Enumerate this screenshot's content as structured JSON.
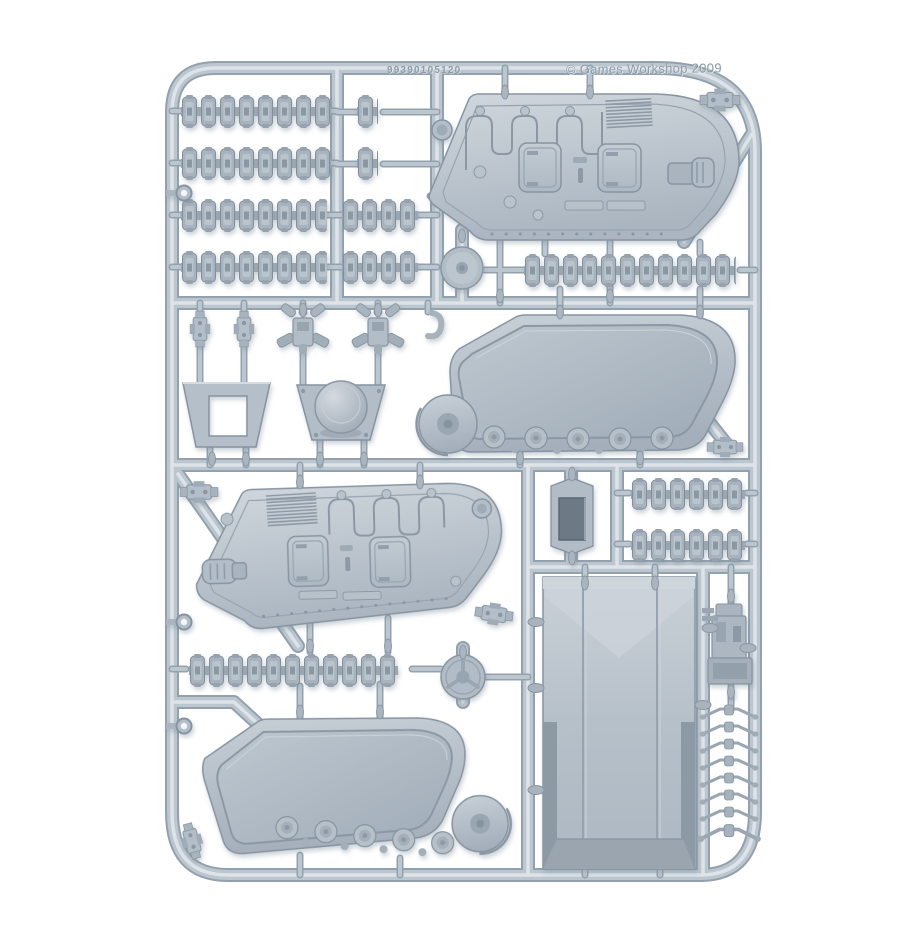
{
  "meta": {
    "description": "Product photograph of a light grey-blue plastic model sprue (injection-moulded frame) for a tracked tank kit, shot on a plain white background",
    "manufacturer_visible": "Games Workshop"
  },
  "palette": {
    "background": "#ffffff",
    "runner-shadow": "#93a1ae",
    "runner-mid": "#bcc6cf",
    "runner-highlight": "#dde3e8",
    "plastic-dark": "#8794a1",
    "panel-light": "#d0d7dd",
    "panel-deep": "#a4afbb",
    "recess-dark": "#6d7985"
  },
  "markings": {
    "molded_code": "99390105120",
    "copyright": "© Games Workshop 2009"
  },
  "parts": {
    "track_link_strips": 10,
    "single_track_links": 2,
    "hull_side_panels": 2,
    "track_guard_inner_panels": 2,
    "large_roof_panel": 1,
    "molded_hatch_doors": 4,
    "dome_hatch": 1,
    "hatch_frame": 1,
    "wheel_discs": 2,
    "suspension_bogies": 2,
    "small_clamp_brackets": 6,
    "weapon_mount": 1,
    "grab_handles": 8,
    "towing_eyes": 3
  }
}
